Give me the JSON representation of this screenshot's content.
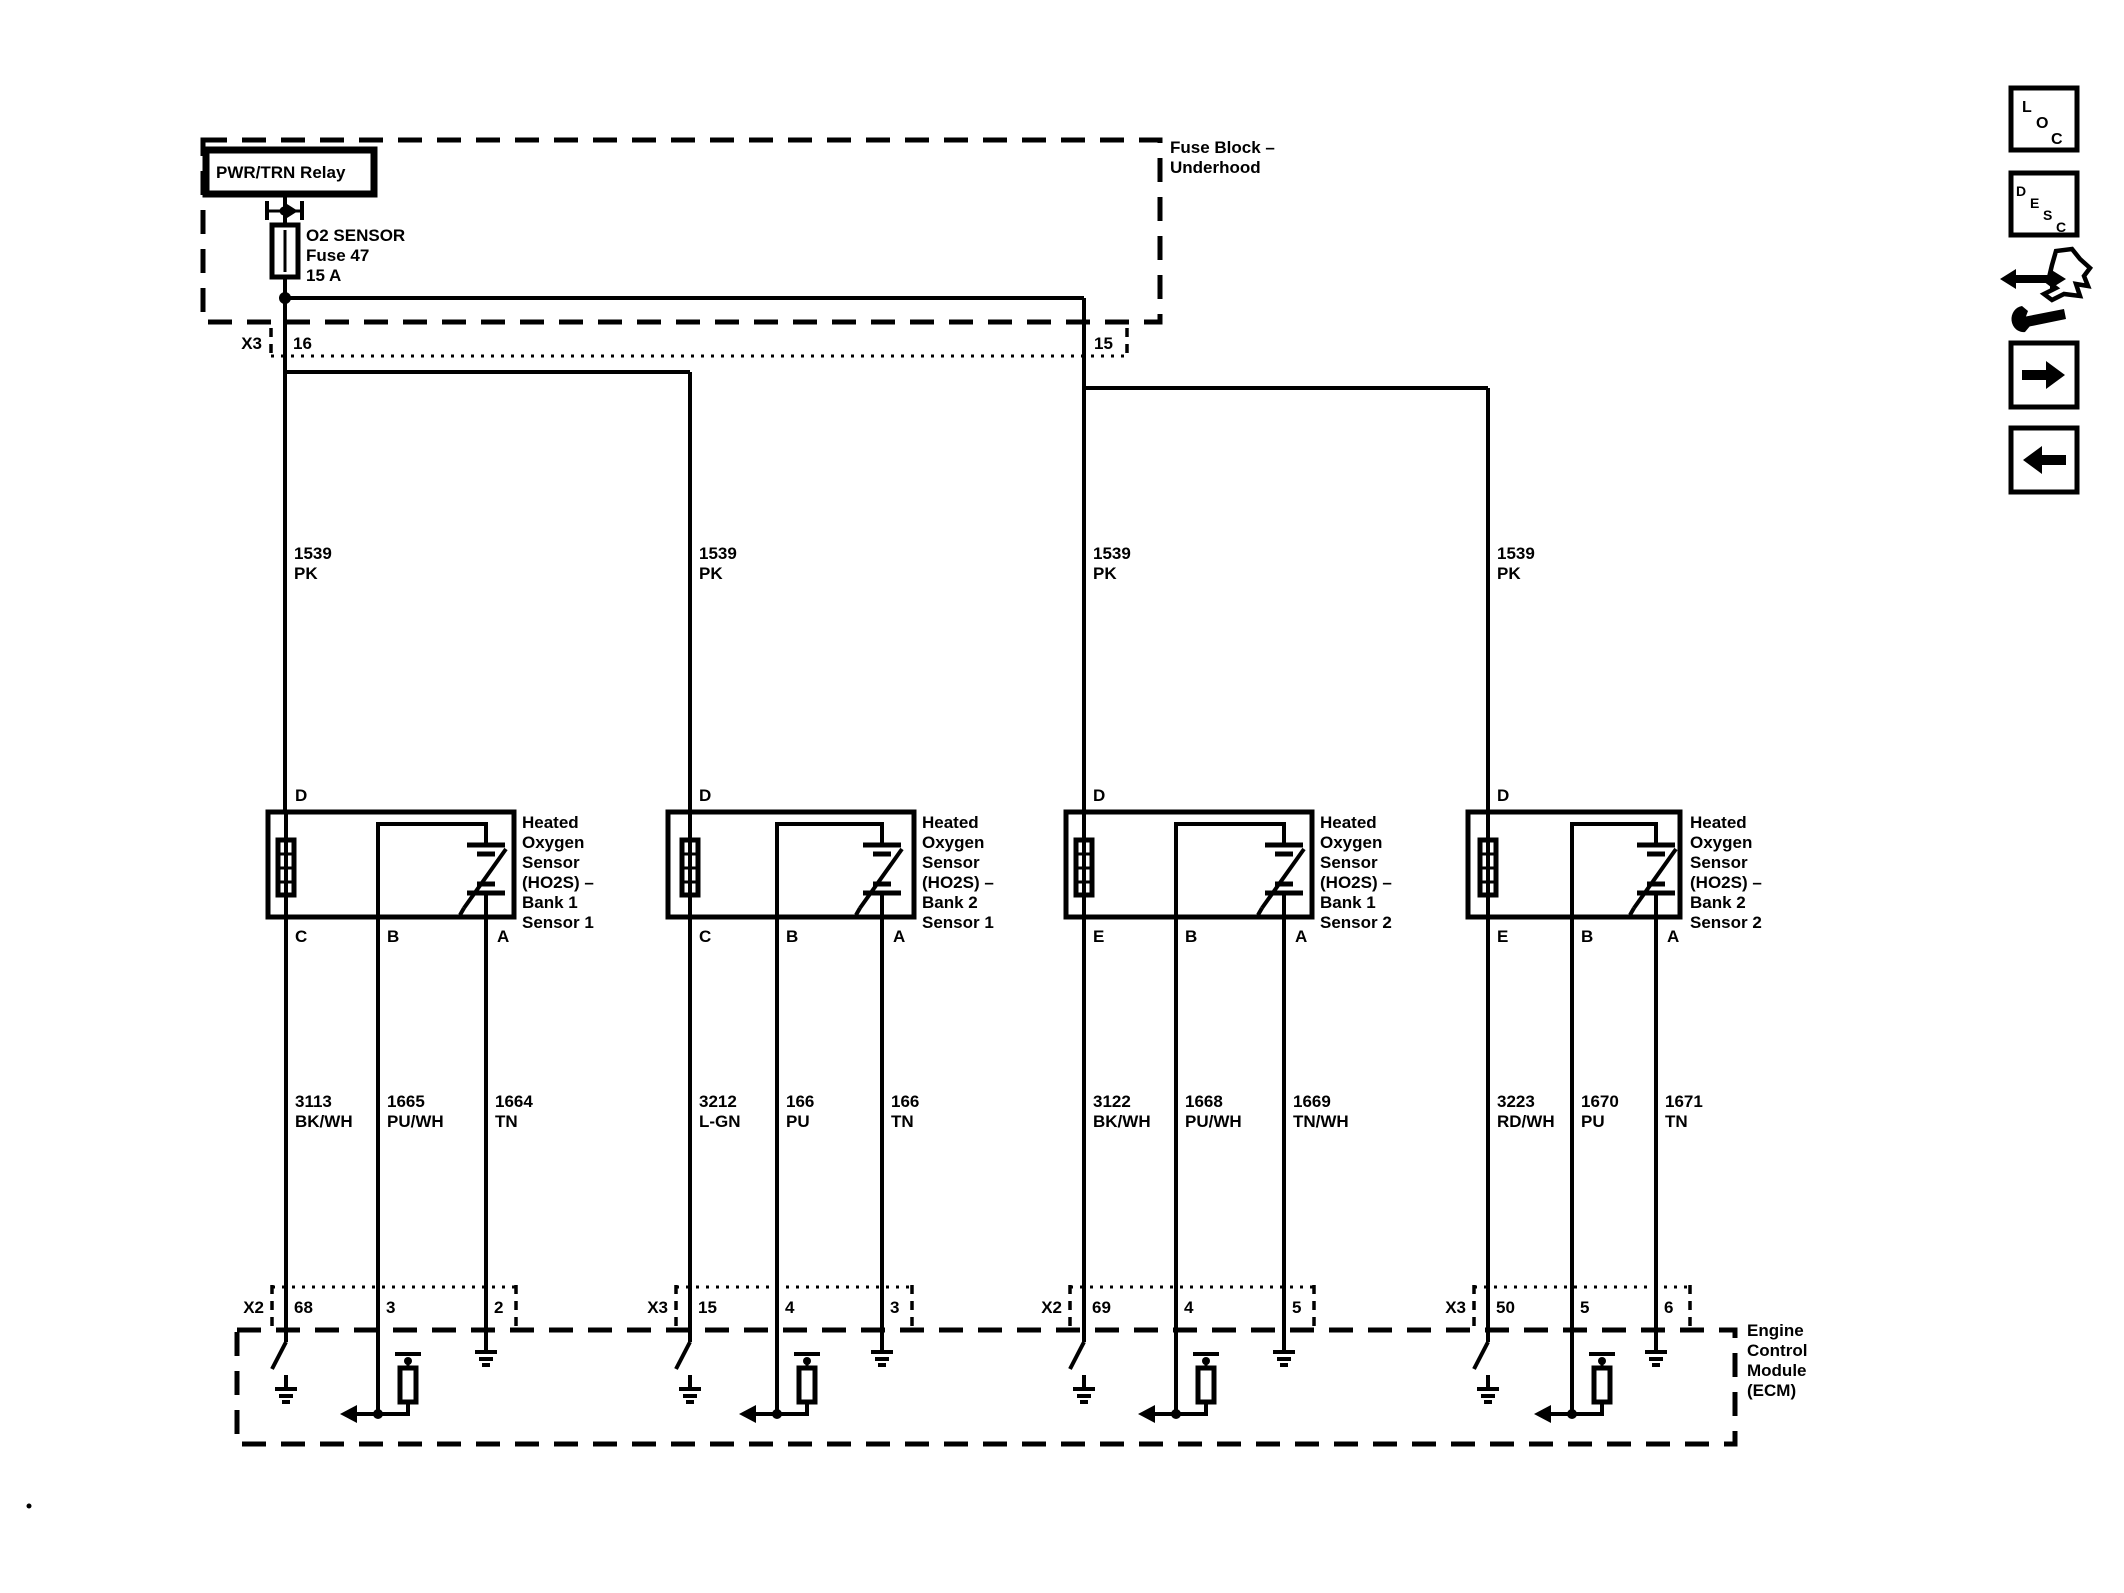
{
  "fuse_block": {
    "title_line1": "Fuse Block –",
    "title_line2": "Underhood",
    "relay_label": "PWR/TRN Relay",
    "fuse_line1": "O2 SENSOR",
    "fuse_line2": "Fuse 47",
    "fuse_line3": "15 A",
    "connector_name": "X3",
    "pin_left": "16",
    "pin_right": "15"
  },
  "feed_circuit": {
    "number": "1539",
    "color": "PK"
  },
  "sensors": [
    {
      "pin_top": "D",
      "pin_1": "C",
      "pin_2": "B",
      "pin_3": "A",
      "label": [
        "Heated",
        "Oxygen",
        "Sensor",
        "(HO2S)  –",
        "Bank 1",
        "Sensor 1"
      ],
      "wire_1": {
        "n": "3113",
        "c": "BK/WH"
      },
      "wire_2": {
        "n": "1665",
        "c": "PU/WH"
      },
      "wire_3": {
        "n": "1664",
        "c": "TN"
      },
      "ecm": {
        "name": "X2",
        "p1": "68",
        "p2": "3",
        "p3": "2"
      }
    },
    {
      "pin_top": "D",
      "pin_1": "C",
      "pin_2": "B",
      "pin_3": "A",
      "label": [
        "Heated",
        "Oxygen",
        "Sensor",
        "(HO2S)  –",
        "Bank 2",
        "Sensor 1"
      ],
      "wire_1": {
        "n": "3212",
        "c": "L-GN"
      },
      "wire_2": {
        "n": "166",
        "c": "PU"
      },
      "wire_3": {
        "n": "166",
        "c": "TN"
      },
      "ecm": {
        "name": "X3",
        "p1": "15",
        "p2": "4",
        "p3": "3"
      }
    },
    {
      "pin_top": "D",
      "pin_1": "E",
      "pin_2": "B",
      "pin_3": "A",
      "label": [
        "Heated",
        "Oxygen",
        "Sensor",
        "(HO2S)  –",
        "Bank 1",
        "Sensor 2"
      ],
      "wire_1": {
        "n": "3122",
        "c": "BK/WH"
      },
      "wire_2": {
        "n": "1668",
        "c": "PU/WH"
      },
      "wire_3": {
        "n": "1669",
        "c": "TN/WH"
      },
      "ecm": {
        "name": "X2",
        "p1": "69",
        "p2": "4",
        "p3": "5"
      }
    },
    {
      "pin_top": "D",
      "pin_1": "E",
      "pin_2": "B",
      "pin_3": "A",
      "label": [
        "Heated",
        "Oxygen",
        "Sensor",
        "(HO2S)  –",
        "Bank 2",
        "Sensor 2"
      ],
      "wire_1": {
        "n": "3223",
        "c": "RD/WH"
      },
      "wire_2": {
        "n": "1670",
        "c": "PU"
      },
      "wire_3": {
        "n": "1671",
        "c": "TN"
      },
      "ecm": {
        "name": "X3",
        "p1": "50",
        "p2": "5",
        "p3": "6"
      }
    }
  ],
  "ecm_label": [
    "Engine",
    "Control",
    "Module",
    "(ECM)"
  ],
  "sidebar": {
    "loc": [
      "L",
      "O",
      "C"
    ],
    "desc": [
      "D",
      "E",
      "S",
      "C"
    ],
    "icons": [
      "hand-arrow-icon",
      "arrow-right-icon",
      "arrow-left-icon"
    ]
  },
  "ink_color": "#000000",
  "background_color": "#ffffff"
}
